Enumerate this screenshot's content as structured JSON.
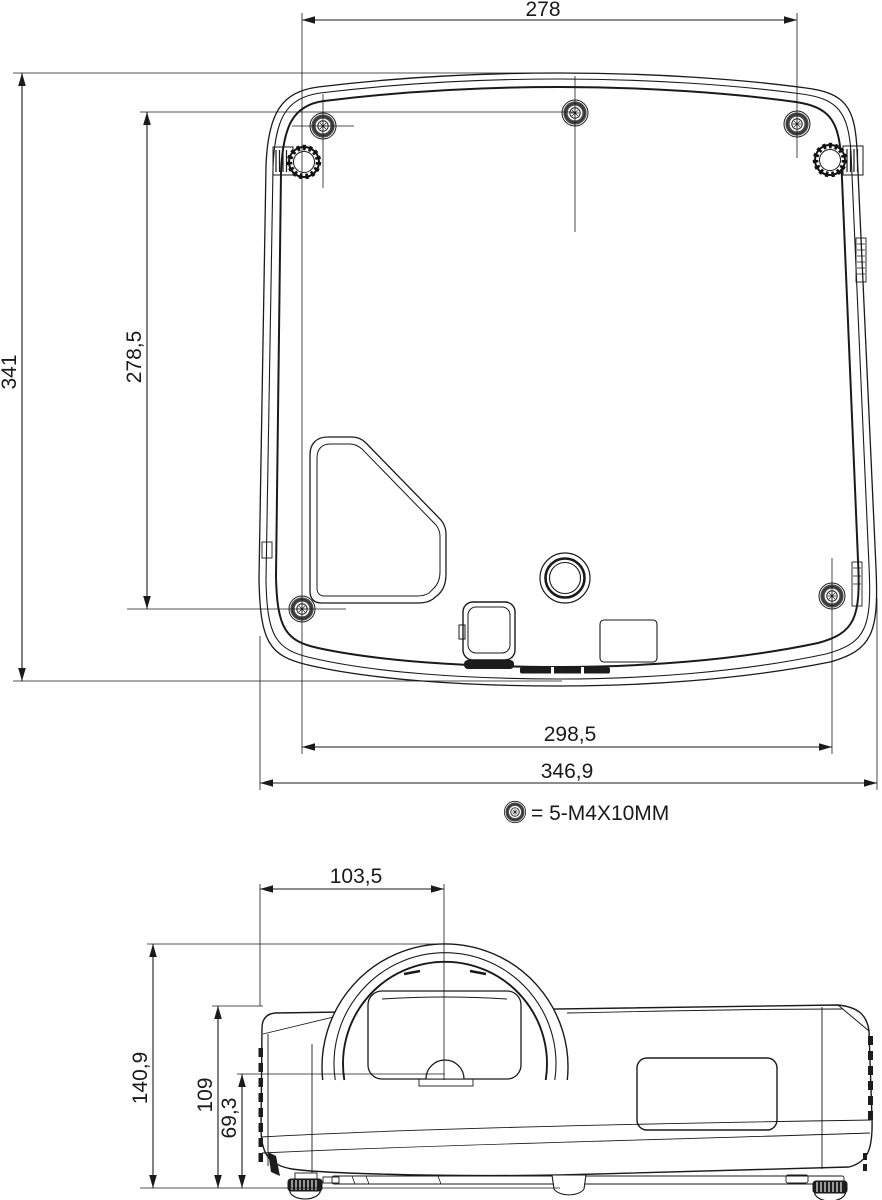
{
  "page": {
    "background": "#ffffff",
    "line_color": "#1a1a1a"
  },
  "drawing": {
    "type": "technical-dimension-drawing",
    "subject": "projector",
    "views": {
      "bottom_view": {
        "name": "bottom view",
        "dimensions": {
          "screw_span_top": "278",
          "overall_depth": "341",
          "screw_span_vertical": "278,5",
          "screw_span_bottom": "298,5",
          "overall_width": "346,9"
        },
        "legend": {
          "symbol": "screw-hole-icon",
          "label": "= 5-M4X10MM"
        }
      },
      "front_view": {
        "name": "front view",
        "dimensions": {
          "lens_center_offset": "103,5",
          "overall_height": "140,9",
          "body_height": "109",
          "lens_center_height": "69,3"
        }
      }
    }
  }
}
